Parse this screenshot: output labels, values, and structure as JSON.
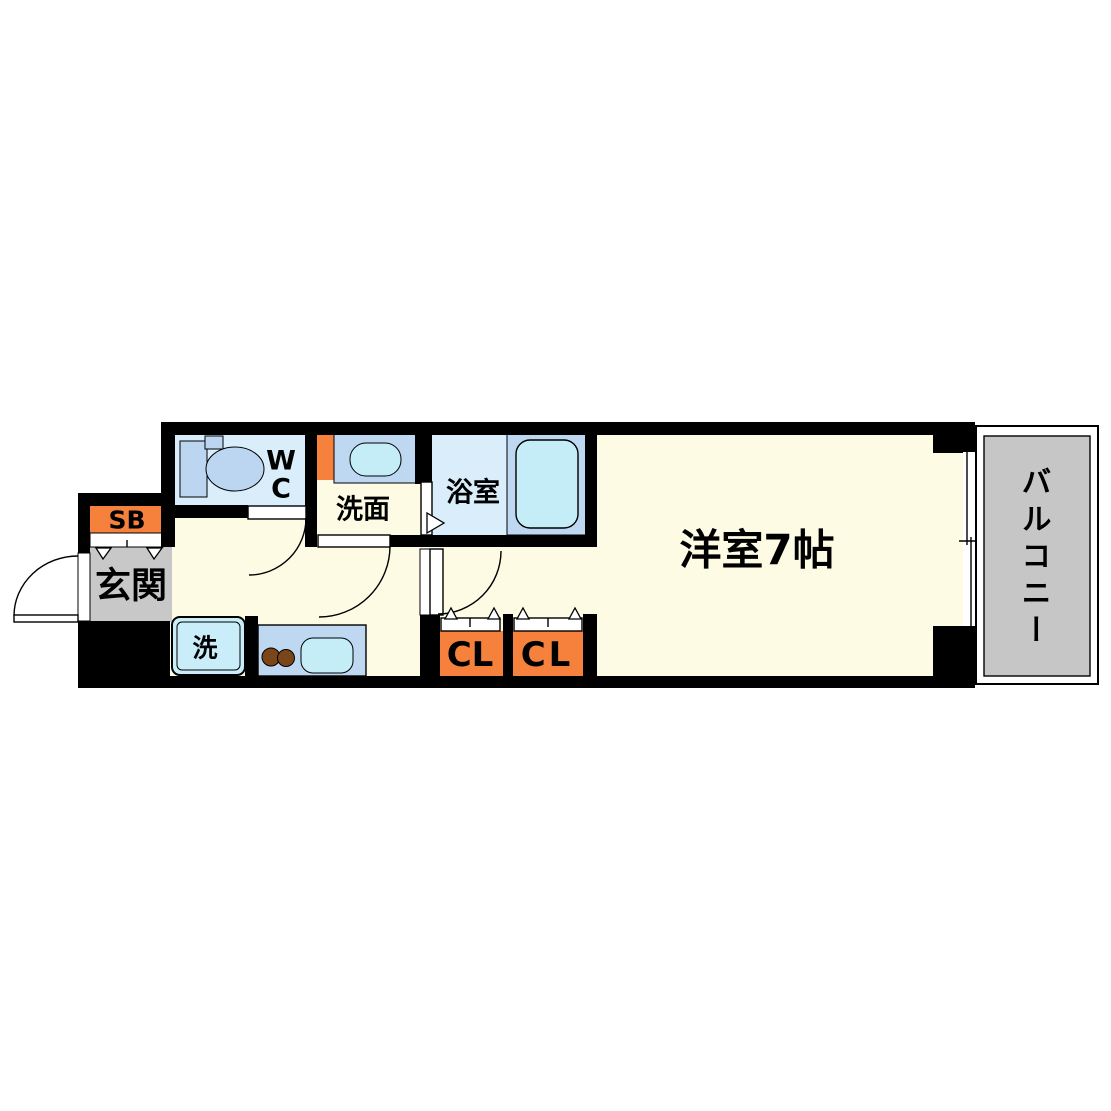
{
  "floorplan": {
    "type": "apartment-floor-plan-1K",
    "rooms": {
      "entrance": {
        "label": "玄関"
      },
      "shoe_box": {
        "label": "SB"
      },
      "toilet": {
        "label": "WC",
        "lines": [
          "W",
          "C"
        ]
      },
      "washroom": {
        "label": "洗面"
      },
      "bathroom": {
        "label": "浴室"
      },
      "washer_space": {
        "label": "洗"
      },
      "closet_left": {
        "label": "CL"
      },
      "closet_right": {
        "label": "CL"
      },
      "western_room": {
        "label": "洋室7帖"
      },
      "balcony": {
        "label": "バルコニー"
      }
    },
    "colors": {
      "wall": "#000000",
      "floor_cream": "#FDFBE4",
      "wet_area_blue": "#D9EEFA",
      "fixture_blue": "#BFD8F2",
      "basin_cyan": "#C4EDF8",
      "accent_orange": "#F5813D",
      "entrance_gray": "#C8C8C8",
      "balcony_gray": "#C6C6C6",
      "burner_brown": "#7A4518"
    }
  }
}
